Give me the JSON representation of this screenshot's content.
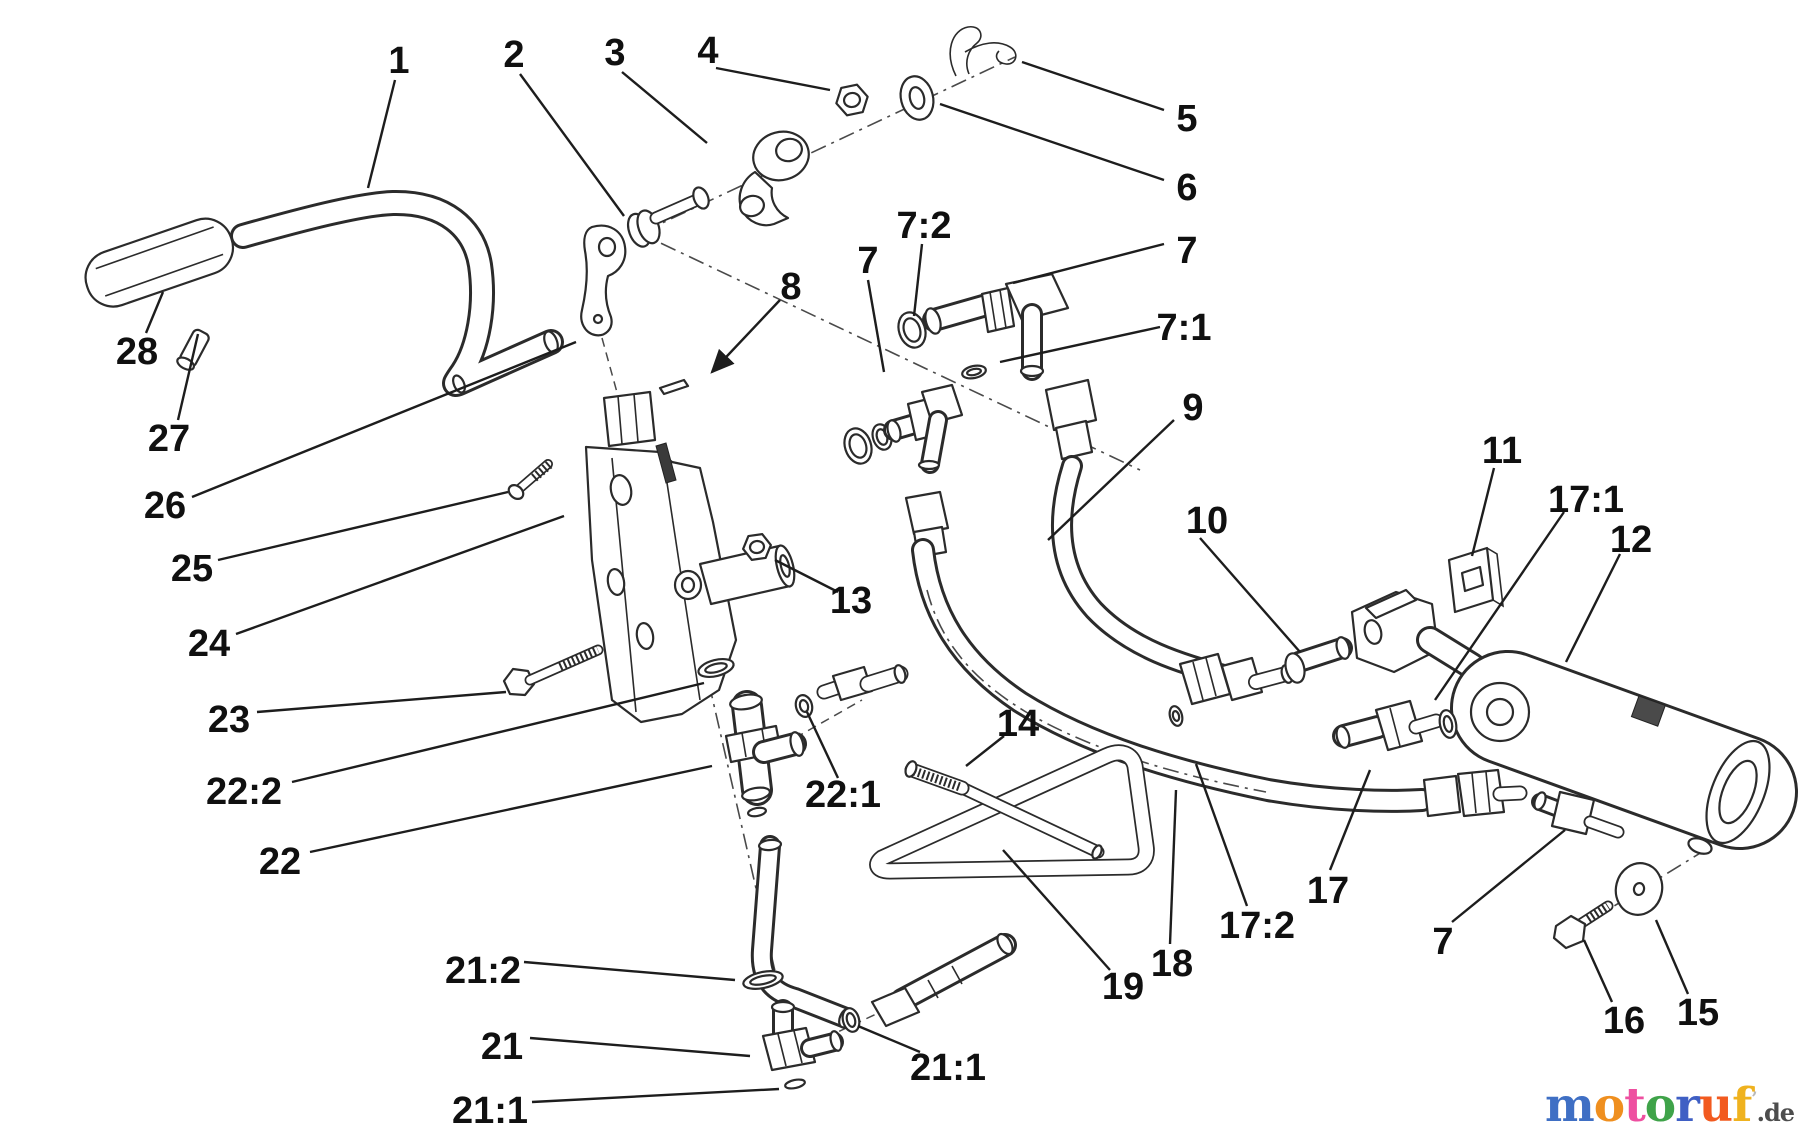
{
  "canvas": {
    "width": 1800,
    "height": 1133,
    "background": "#ffffff"
  },
  "colors": {
    "line": "#2b2b2b",
    "label_text": "#101010",
    "leader": "#1d1d1d"
  },
  "diagram": {
    "type": "exploded-parts-diagram",
    "labels": [
      {
        "id": "1",
        "text": "1",
        "x": 399,
        "y": 60,
        "leader": [
          395,
          80,
          368,
          188
        ]
      },
      {
        "id": "2",
        "text": "2",
        "x": 514,
        "y": 54,
        "leader": [
          520,
          74,
          624,
          216
        ]
      },
      {
        "id": "3",
        "text": "3",
        "x": 615,
        "y": 52,
        "leader": [
          622,
          72,
          707,
          143
        ]
      },
      {
        "id": "4",
        "text": "4",
        "x": 708,
        "y": 50,
        "leader": [
          716,
          68,
          830,
          90
        ]
      },
      {
        "id": "5",
        "text": "5",
        "x": 1187,
        "y": 118,
        "leader": [
          1164,
          110,
          1022,
          62
        ]
      },
      {
        "id": "6",
        "text": "6",
        "x": 1187,
        "y": 187,
        "leader": [
          1164,
          180,
          940,
          104
        ]
      },
      {
        "id": "7-top",
        "text": "7",
        "x": 1187,
        "y": 250,
        "leader": [
          1164,
          244,
          1013,
          283
        ]
      },
      {
        "id": "7-2",
        "text": "7:2",
        "x": 924,
        "y": 225,
        "leader": [
          922,
          244,
          914,
          316
        ]
      },
      {
        "id": "7-mid",
        "text": "7",
        "x": 868,
        "y": 260,
        "leader": [
          868,
          280,
          884,
          372
        ]
      },
      {
        "id": "7-1",
        "text": "7:1",
        "x": 1184,
        "y": 327,
        "leader": [
          1160,
          327,
          1000,
          362
        ]
      },
      {
        "id": "8",
        "text": "8",
        "x": 791,
        "y": 286,
        "leader": [
          780,
          300,
          712,
          372
        ],
        "arrow": true
      },
      {
        "id": "9",
        "text": "9",
        "x": 1193,
        "y": 407,
        "leader": [
          1174,
          420,
          1048,
          540
        ]
      },
      {
        "id": "10",
        "text": "10",
        "x": 1207,
        "y": 520,
        "leader": [
          1200,
          538,
          1300,
          652
        ]
      },
      {
        "id": "11",
        "text": "11",
        "x": 1502,
        "y": 450,
        "leader": [
          1494,
          468,
          1472,
          556
        ]
      },
      {
        "id": "17-1",
        "text": "17:1",
        "x": 1586,
        "y": 499,
        "leader": [
          1564,
          512,
          1435,
          700
        ]
      },
      {
        "id": "12",
        "text": "12",
        "x": 1631,
        "y": 539,
        "leader": [
          1620,
          554,
          1566,
          662
        ]
      },
      {
        "id": "13",
        "text": "13",
        "x": 851,
        "y": 600,
        "leader": [
          838,
          592,
          775,
          560
        ]
      },
      {
        "id": "26",
        "text": "26",
        "x": 165,
        "y": 505,
        "leader": [
          192,
          497,
          576,
          342
        ]
      },
      {
        "id": "25",
        "text": "25",
        "x": 192,
        "y": 568,
        "leader": [
          218,
          560,
          508,
          492
        ]
      },
      {
        "id": "24",
        "text": "24",
        "x": 209,
        "y": 643,
        "leader": [
          236,
          634,
          564,
          516
        ]
      },
      {
        "id": "23",
        "text": "23",
        "x": 229,
        "y": 719,
        "leader": [
          257,
          712,
          506,
          692
        ]
      },
      {
        "id": "22-2",
        "text": "22:2",
        "x": 244,
        "y": 791,
        "leader": [
          292,
          782,
          704,
          683
        ]
      },
      {
        "id": "22",
        "text": "22",
        "x": 280,
        "y": 861,
        "leader": [
          310,
          852,
          712,
          766
        ]
      },
      {
        "id": "22-1",
        "text": "22:1",
        "x": 843,
        "y": 794,
        "leader": [
          838,
          778,
          807,
          712
        ]
      },
      {
        "id": "27",
        "text": "27",
        "x": 169,
        "y": 438,
        "leader": [
          178,
          420,
          198,
          334
        ]
      },
      {
        "id": "28",
        "text": "28",
        "x": 137,
        "y": 351,
        "leader": [
          146,
          333,
          163,
          292
        ]
      },
      {
        "id": "21-2",
        "text": "21:2",
        "x": 483,
        "y": 970,
        "leader": [
          524,
          962,
          735,
          980
        ]
      },
      {
        "id": "21",
        "text": "21",
        "x": 502,
        "y": 1046,
        "leader": [
          530,
          1038,
          750,
          1056
        ]
      },
      {
        "id": "21-1a",
        "text": "21:1",
        "x": 490,
        "y": 1110,
        "leader": [
          532,
          1102,
          779,
          1089
        ]
      },
      {
        "id": "21-1b",
        "text": "21:1",
        "x": 948,
        "y": 1067,
        "leader": [
          920,
          1052,
          858,
          1026
        ]
      },
      {
        "id": "14",
        "text": "14",
        "x": 1018,
        "y": 723,
        "leader": [
          1004,
          736,
          966,
          766
        ]
      },
      {
        "id": "19",
        "text": "19",
        "x": 1123,
        "y": 986,
        "leader": [
          1110,
          970,
          1003,
          850
        ]
      },
      {
        "id": "18",
        "text": "18",
        "x": 1172,
        "y": 963,
        "leader": [
          1170,
          944,
          1176,
          790
        ]
      },
      {
        "id": "17-2",
        "text": "17:2",
        "x": 1257,
        "y": 925,
        "leader": [
          1247,
          906,
          1196,
          764
        ]
      },
      {
        "id": "17",
        "text": "17",
        "x": 1328,
        "y": 890,
        "leader": [
          1330,
          870,
          1370,
          770
        ]
      },
      {
        "id": "7-bot",
        "text": "7",
        "x": 1443,
        "y": 941,
        "leader": [
          1452,
          922,
          1565,
          830
        ]
      },
      {
        "id": "16",
        "text": "16",
        "x": 1624,
        "y": 1020,
        "leader": [
          1612,
          1002,
          1584,
          940
        ]
      },
      {
        "id": "15",
        "text": "15",
        "x": 1698,
        "y": 1012,
        "leader": [
          1688,
          994,
          1656,
          920
        ]
      }
    ]
  },
  "watermark": {
    "letters": [
      {
        "char": "m",
        "color": "#3f6fc4"
      },
      {
        "char": "o",
        "color": "#ef8f1f"
      },
      {
        "char": "t",
        "color": "#ee4fa0"
      },
      {
        "char": "o",
        "color": "#3fa349"
      },
      {
        "char": "r",
        "color": "#3f5fc4"
      },
      {
        "char": "u",
        "color": "#f25a1f"
      },
      {
        "char": "f",
        "color": "#efb21f"
      }
    ],
    "tick": "’",
    "suffix": ".de",
    "suffix_color": "#4d4d4d"
  }
}
